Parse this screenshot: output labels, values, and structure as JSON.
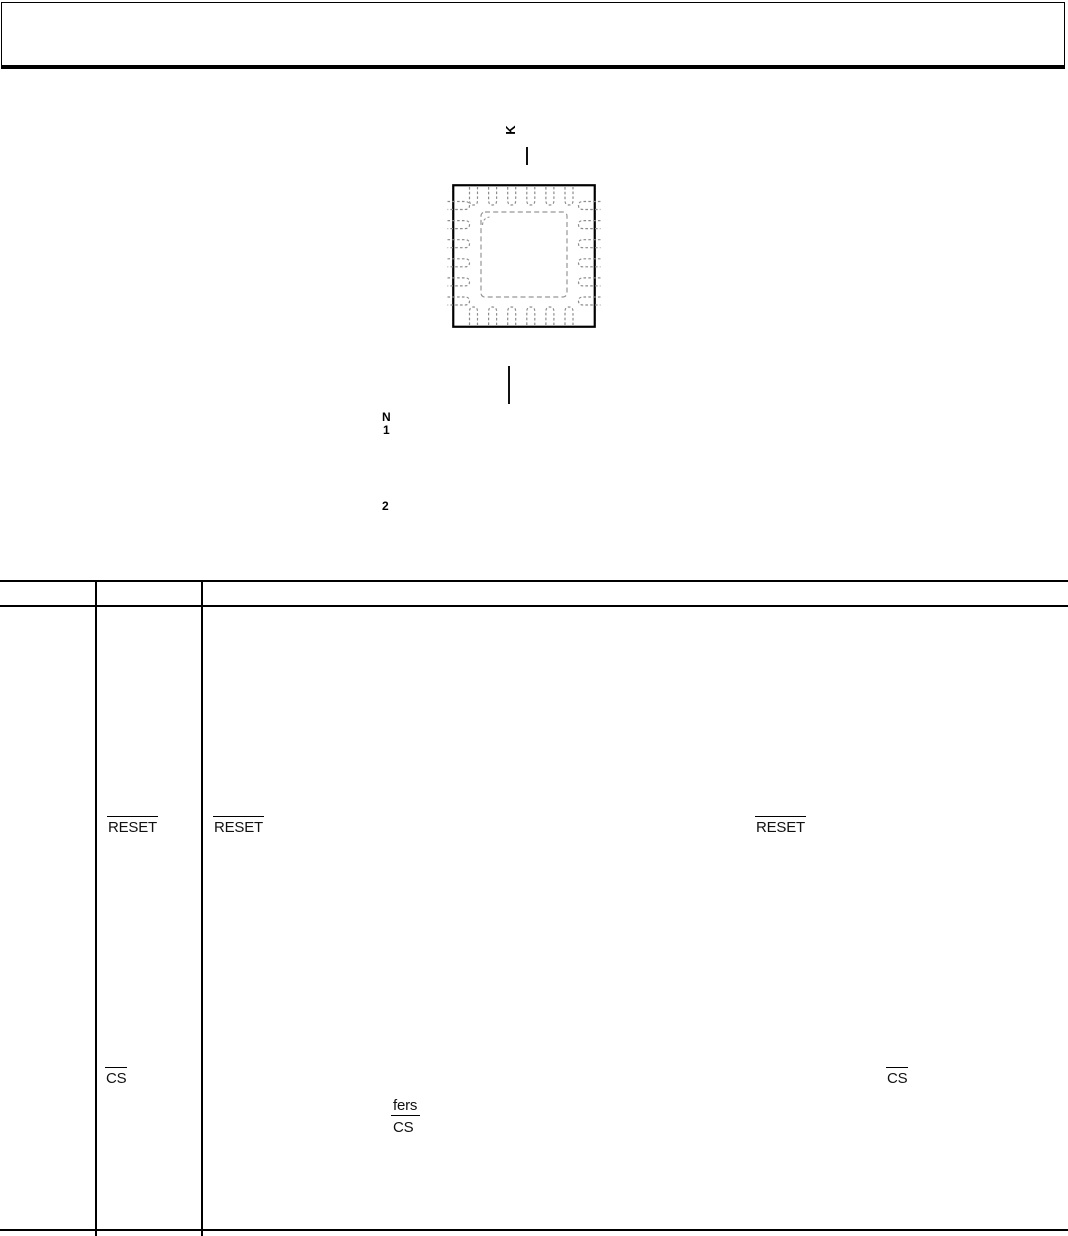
{
  "colors": {
    "ink": "#000000",
    "pin_dash": "#8c8c8c",
    "background": "#ffffff"
  },
  "pin_diagram": {
    "rotated_pin_label": "K",
    "notes_heading_fragment": "N",
    "note_number_1": "1",
    "note_number_2": "2"
  },
  "pin_table": {
    "reset_row": {
      "pin_mnemonic": "RESET",
      "description_lead_mnemonic": "RESET",
      "description_inline_mnemonic": "RESET"
    },
    "cs_row": {
      "pin_mnemonic": "CS",
      "description_fragment_line1": "fers",
      "description_fragment_line2": "CS",
      "description_inline_mnemonic": "CS"
    }
  }
}
